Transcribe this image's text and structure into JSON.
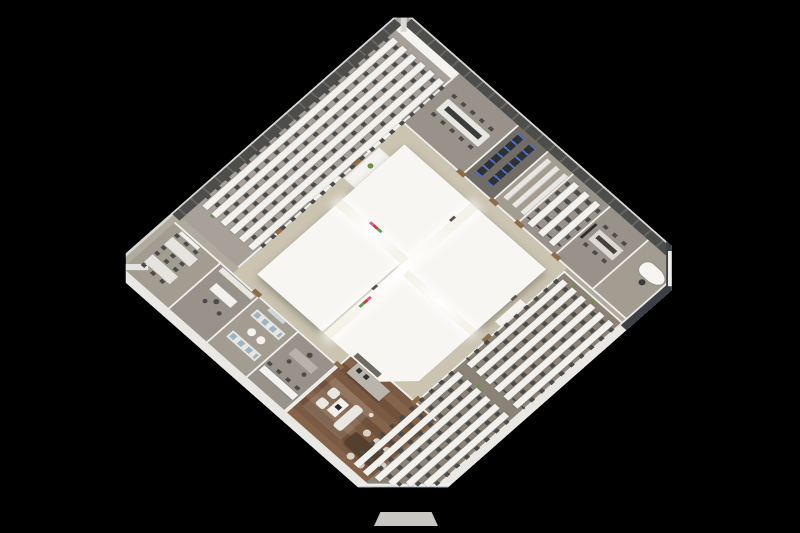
{
  "scene": {
    "type": "3d-floorplan-render",
    "description": "Isometric 3D cutaway rendering of a square office floor plate rotated 45 degrees, viewed from above on a black background",
    "background": "#000000",
    "view": {
      "rotation_deg": 45,
      "vertical_scale": 0.88
    }
  },
  "palette": {
    "bg": "#000000",
    "base": "#b0aa9f",
    "corridor": "#cbc4b1",
    "carpet-nw": "#a7a19a",
    "carpet-se": "#8b8376",
    "room": "#98928a",
    "room-dark": "#716d66",
    "room-light": "#a39c91",
    "core": "#f7f6f3",
    "wall": "#f0efec",
    "wall-ext": "#e9e8e4",
    "edge": "#d8d7d3",
    "panel": "#4d4d4b",
    "panel-line": "#656561",
    "glazing": "#3c4046",
    "chair": "#4b4b4b",
    "desk": "#f2f1ee",
    "plant": "#6f8f4f",
    "wood-accent": "#8d6b47",
    "wood-a": "#7b5a43",
    "wood-b": "#86644b",
    "wood-c": "#70523c",
    "table-dark": "#55402d",
    "cream": "#d9d3c6",
    "sofa-blue": "#9db4c4",
    "island": "#b9b5ac",
    "logo-pink": "#e0558a",
    "logo-red": "#cf3b3b",
    "logo-green": "#5a9e4c"
  },
  "floorplan": {
    "core": {
      "name": "central-core",
      "blocks": 4,
      "atrium": "bright skylight cross between the four white core volumes",
      "logo_wall": "small pink/red/green brand marks on corridor-facing core faces"
    },
    "corridor": {
      "name": "corridor-ring",
      "description": "tan circulation loop around the core connecting all perimeter zones"
    },
    "open_offices": [
      {
        "id": "open-office-northwest",
        "rows": 6,
        "desks_per_row_per_side": 12,
        "orientation": "benches parallel to northwest facade",
        "plants": 4
      },
      {
        "id": "open-office-southeast",
        "banks": 2,
        "rows_per_bank": 6,
        "desks_per_row_per_side": 5,
        "orientation": "benches parallel to southeast facade",
        "plants": 3
      }
    ],
    "perimeter_rooms_northeast": [
      {
        "id": "conference-room",
        "furniture": "12-seat boardroom table with dark runner"
      },
      {
        "id": "server-room",
        "furniture": "two dark server cabinet rows"
      },
      {
        "id": "storage-room",
        "furniture": "three white shelving units"
      },
      {
        "id": "team-room",
        "rows": 3,
        "furniture": "three shared desk rows"
      },
      {
        "id": "meeting-room",
        "furniture": "8-seat table, wall display"
      },
      {
        "id": "corner-office",
        "furniture": "curved executive desk, credenza, dark corner glazing"
      }
    ],
    "perimeter_rooms_southwest": [
      {
        "id": "meeting-room-west",
        "furniture": "two 4-seat tables, whiteboard"
      },
      {
        "id": "manager-office-a",
        "furniture": "desk, shelf wall, two guest chairs"
      },
      {
        "id": "lounge",
        "furniture": "two blue-cushion sofas, two round side tables, wall art"
      },
      {
        "id": "manager-office-b",
        "furniture": "gray desk, two guest chairs, touchdown bench"
      },
      {
        "id": "executive-suite",
        "floor": "wood planks",
        "furniture": "kitchen island with appliances, sofa set with coffee table and laptop, floor lamp, 6-seat dark-wood meeting table"
      }
    ],
    "entrance": {
      "id": "entrance-step",
      "location": "chamfered bottom corner of the floor plate"
    }
  }
}
